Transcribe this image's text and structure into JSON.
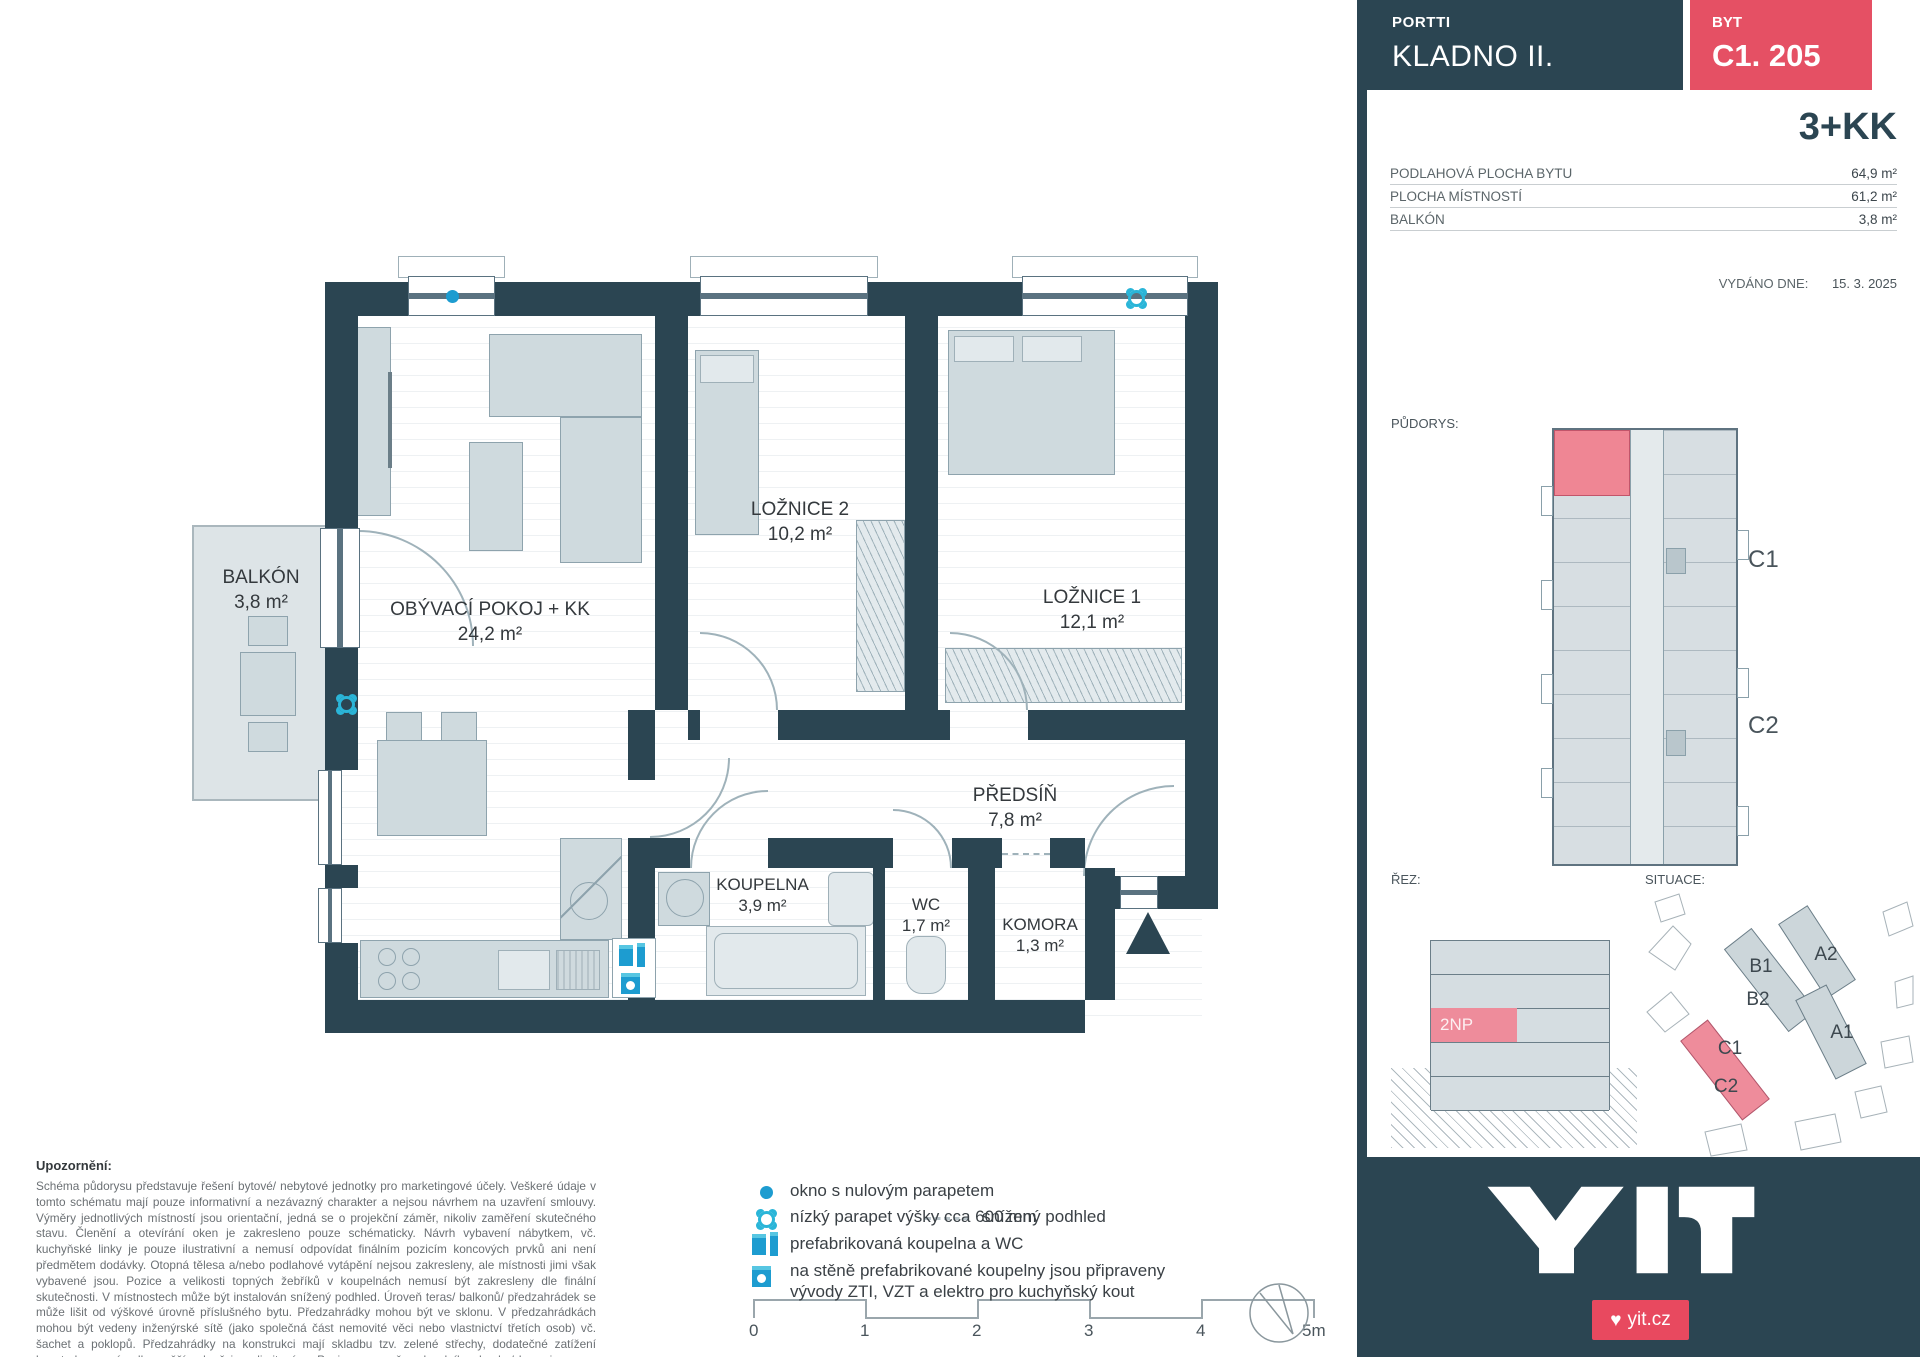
{
  "header": {
    "project": "PORTTI",
    "title": "KLADNO II.",
    "byt_label": "BYT",
    "unit": "C1. 205",
    "disposition": "3+KK"
  },
  "summary": {
    "rows": [
      {
        "label": "PODLAHOVÁ PLOCHA BYTU",
        "value": "64,9 m²"
      },
      {
        "label": "PLOCHA MÍSTNOSTÍ",
        "value": "61,2 m²"
      },
      {
        "label": "BALKÓN",
        "value": "3,8 m²"
      }
    ],
    "issued_label": "VYDÁNO DNE:",
    "issued_value": "15. 3. 2025"
  },
  "plan": {
    "rooms": [
      {
        "name": "BALKÓN",
        "area": "3,8 m²"
      },
      {
        "name": "OBÝVACÍ POKOJ + KK",
        "area": "24,2 m²"
      },
      {
        "name": "LOŽNICE 2",
        "area": "10,2 m²"
      },
      {
        "name": "LOŽNICE 1",
        "area": "12,1 m²"
      },
      {
        "name": "PŘEDSÍŇ",
        "area": "7,8 m²"
      },
      {
        "name": "KOUPELNA",
        "area": "3,9 m²"
      },
      {
        "name": "WC",
        "area": "1,7 m²"
      },
      {
        "name": "KOMORA",
        "area": "1,3 m²"
      }
    ]
  },
  "sidebar_sections": {
    "pudorys_label": "PŮDORYS:",
    "rez_label": "ŘEZ:",
    "situace_label": "SITUACE:",
    "floor_highlight": "2NP",
    "block_c1": "C1",
    "block_c2": "C2",
    "site": {
      "b1": "B1",
      "b2": "B2",
      "a2": "A2",
      "a1": "A1",
      "c1": "C1",
      "c2": "C2"
    }
  },
  "legend": {
    "items": [
      {
        "label": "okno s nulovým parapetem"
      },
      {
        "label": "nízký parapet výšky cca 600 mm"
      },
      {
        "label": "snížený podhled"
      },
      {
        "label": "prefabrikovaná koupelna a WC"
      },
      {
        "label": "na stěně prefabrikované koupelny jsou připraveny vývody ZTI, VZT a elektro pro kuchyňský kout"
      }
    ]
  },
  "scalebar": {
    "ticks": [
      "0",
      "1",
      "2",
      "3",
      "4",
      "5m"
    ]
  },
  "notes": {
    "title": "Upozornění:",
    "body": "Schéma půdorysu představuje řešení bytové/ nebytové jednotky pro marketingové účely. Veškeré údaje v tomto schématu mají pouze informativní a nezávazný charakter a nejsou návrhem na uzavření smlouvy. Výměry jednotlivých místností jsou orientační, jedná se o projekční záměr, nikoliv zaměření skutečného stavu. Členění a otevírání oken je zakresleno pouze schématicky. Návrh vybavení nábytkem, vč. kuchyňské linky je pouze ilustrativní a nemusí odpovídat finálním pozicím koncových prvků ani není předmětem dodávky. Otopná tělesa a/nebo podlahové vytápění nejsou zakresleny, ale místnosti jimi však vybavené jsou. Pozice a velikosti topných žebříků v koupelnách nemusí být zakresleny dle finální skutečnosti. V místnostech může být instalován snížený podhled. Úroveň teras/ balkonů/ předzahrádek se může lišit od výškové úrovně příslušného bytu. Předzahrádky mohou být ve sklonu. V předzahrádkách mohou být vedeny inženýrské sítě (jako společná část nemovité věci nebo vlastnictví třetích osob) vč. šachet a poklopů. Předzahrádky na konstrukci mají skladbu tzv. zelené střechy, dodatečné zatížení konstrukce a výsadba vyšší zeleně jsou limitovány. Pozice a rozměr zahradního domku/ boxu je pouze orientační."
  },
  "footer": {
    "logo": "YIT",
    "website": "yit.cz"
  },
  "colors": {
    "wall": "#2b4552",
    "accent_red": "#e55064",
    "badge_red": "#e8495f",
    "highlight_pink": "#ee8c9b",
    "legend_blue": "#1d9cd0",
    "marker_blue": "#2ab5d8",
    "furniture": "#cfdade"
  }
}
